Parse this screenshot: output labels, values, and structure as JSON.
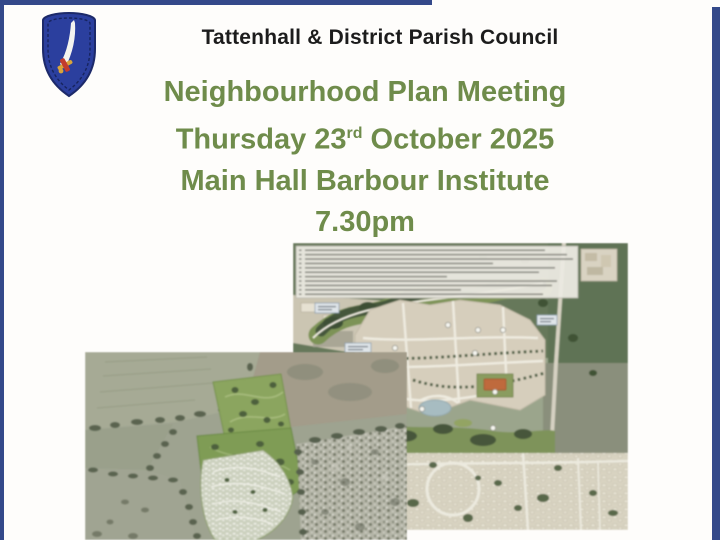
{
  "page": {
    "background": "#fefdfb",
    "frame_color": "#34498a"
  },
  "header": {
    "council_name": "Tattenhall & District Parish Council",
    "crest": "blue-shield-with-white-scimitar"
  },
  "title": {
    "color": "#6f8c4b",
    "line1": "Neighbourhood Plan Meeting",
    "date_prefix": "Thursday 23",
    "date_ordinal": "rd",
    "date_suffix": " October 2025",
    "line3": "Main Hall Barbour Institute",
    "line4": "7.30pm"
  },
  "maps": {
    "masterplan": {
      "label": "proposed-development-masterplan-with-annotation-key"
    },
    "aerial": {
      "label": "aerial-photograph-with-plan-overlay"
    }
  }
}
